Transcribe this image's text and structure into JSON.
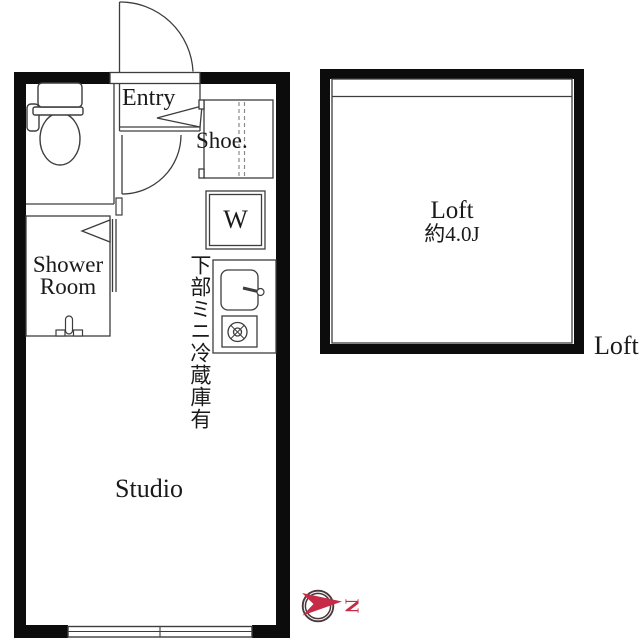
{
  "floorplan": {
    "colors": {
      "wall": "#0c0c0c",
      "line": "#3d3d3d",
      "shelf_dash": "#8a8a8a",
      "compass_ring": "#4a393c",
      "compass_red": "#c62a47"
    },
    "unit": {
      "entry_label": "Entry",
      "shoe_closet_label": "Shoe.",
      "washer_label": "W",
      "shower_room_label_line1": "Shower",
      "shower_room_label_line2": "Room",
      "studio_label": "Studio",
      "fridge_note_vertical": "下部ミニ冷蔵庫有"
    },
    "loft": {
      "name": "Loft",
      "area": "約4.0J",
      "outside_label": "Loft"
    },
    "compass": {
      "north_letter": "N"
    }
  }
}
